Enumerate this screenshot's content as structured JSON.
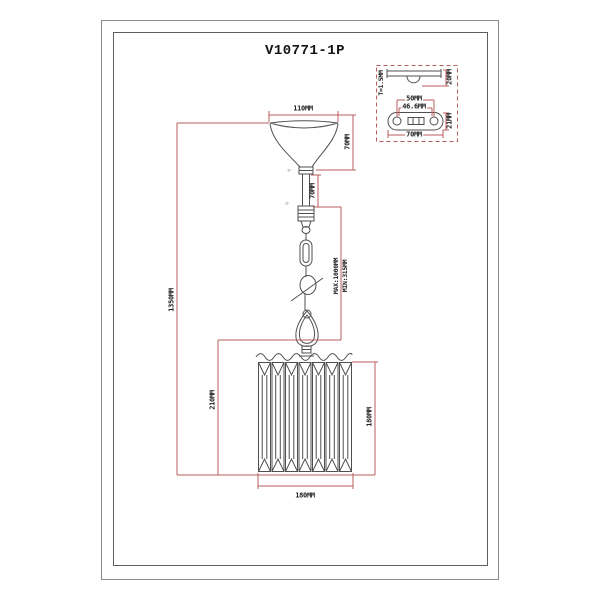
{
  "colors": {
    "dimension_line": "#b85c5c",
    "drawing_line": "#4f4f4f",
    "frame": "#8a8a8a"
  },
  "title": "V10771-1P",
  "pendant": {
    "canopy_width": "110MM",
    "canopy_height": "70MM",
    "stem_length": "70MM",
    "suspension_max": "MAX:1000MM",
    "suspension_min": "MIN:315MM",
    "overall_height": "1350MM",
    "lower_section_height": "210MM",
    "shade_height": "180MM",
    "shade_width": "180MM",
    "diameter_mark": "⌀"
  },
  "mount_plate": {
    "thickness": "T=1.5MM",
    "bracket_height": "20MM",
    "hole_spacing": "50MM",
    "slot_length": "46.6MM",
    "plate_length": "70MM",
    "plate_width": "21MM"
  }
}
